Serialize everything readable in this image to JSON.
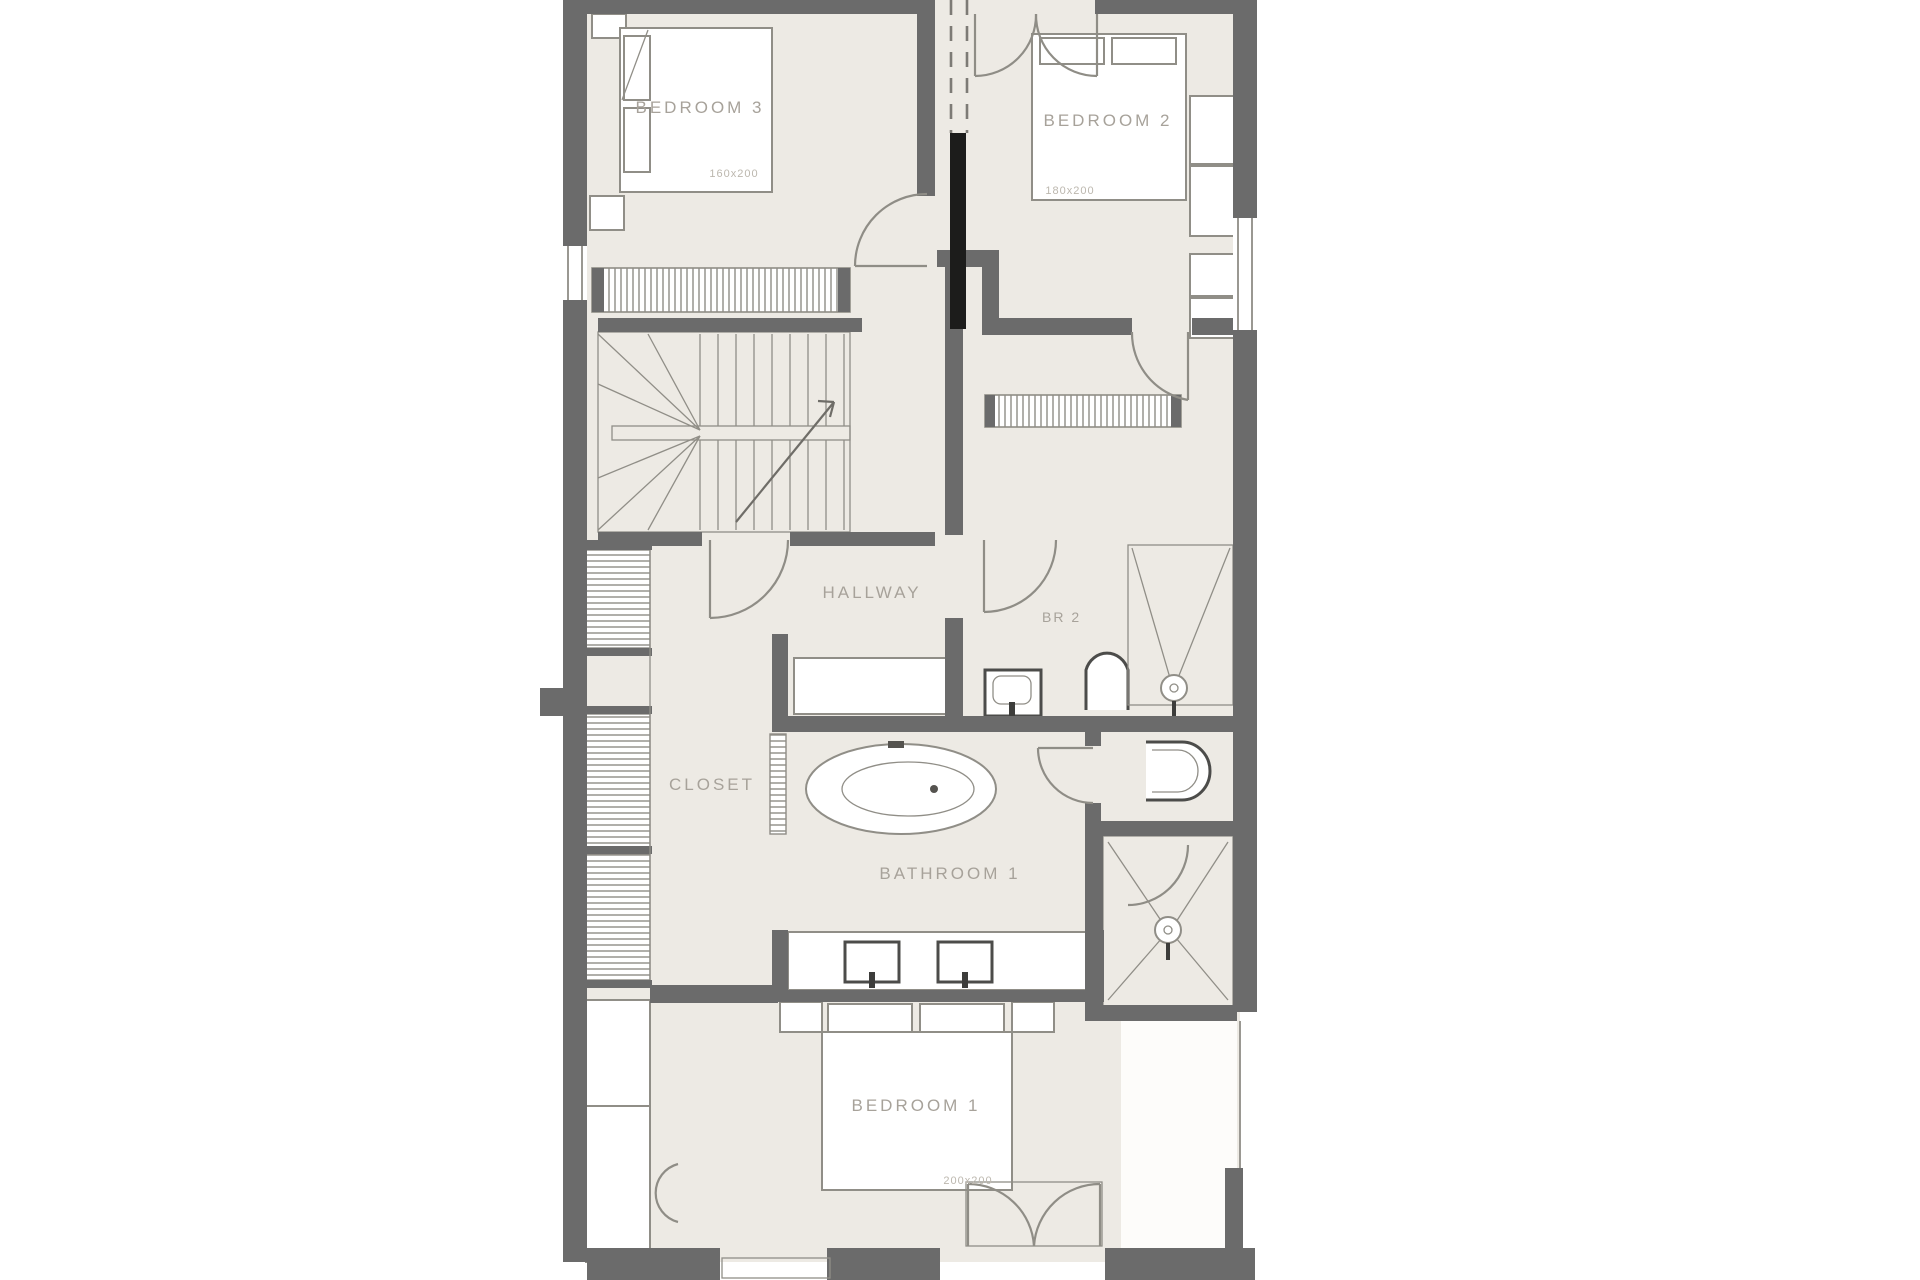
{
  "plan": {
    "title": "upper-floor-plan",
    "rooms": {
      "bedroom3": {
        "label": "BEDROOM 3",
        "dimensions": "160x200"
      },
      "bedroom2": {
        "label": "BEDROOM 2",
        "dimensions": "180x200"
      },
      "bedroom1": {
        "label": "BEDROOM 1",
        "dimensions": "200x200"
      },
      "hallway": {
        "label": "HALLWAY"
      },
      "br2": {
        "label": "BR 2"
      },
      "closet": {
        "label": "CLOSET"
      },
      "bathroom1": {
        "label": "BATHROOM 1"
      }
    },
    "colors": {
      "floor": "#edeae4",
      "wall": "#6b6b6b",
      "line": "#908e87",
      "accent": "#1c1c1b",
      "label": "#a7a29a",
      "dim": "#bcb7ae",
      "window": "#9a9892"
    }
  }
}
